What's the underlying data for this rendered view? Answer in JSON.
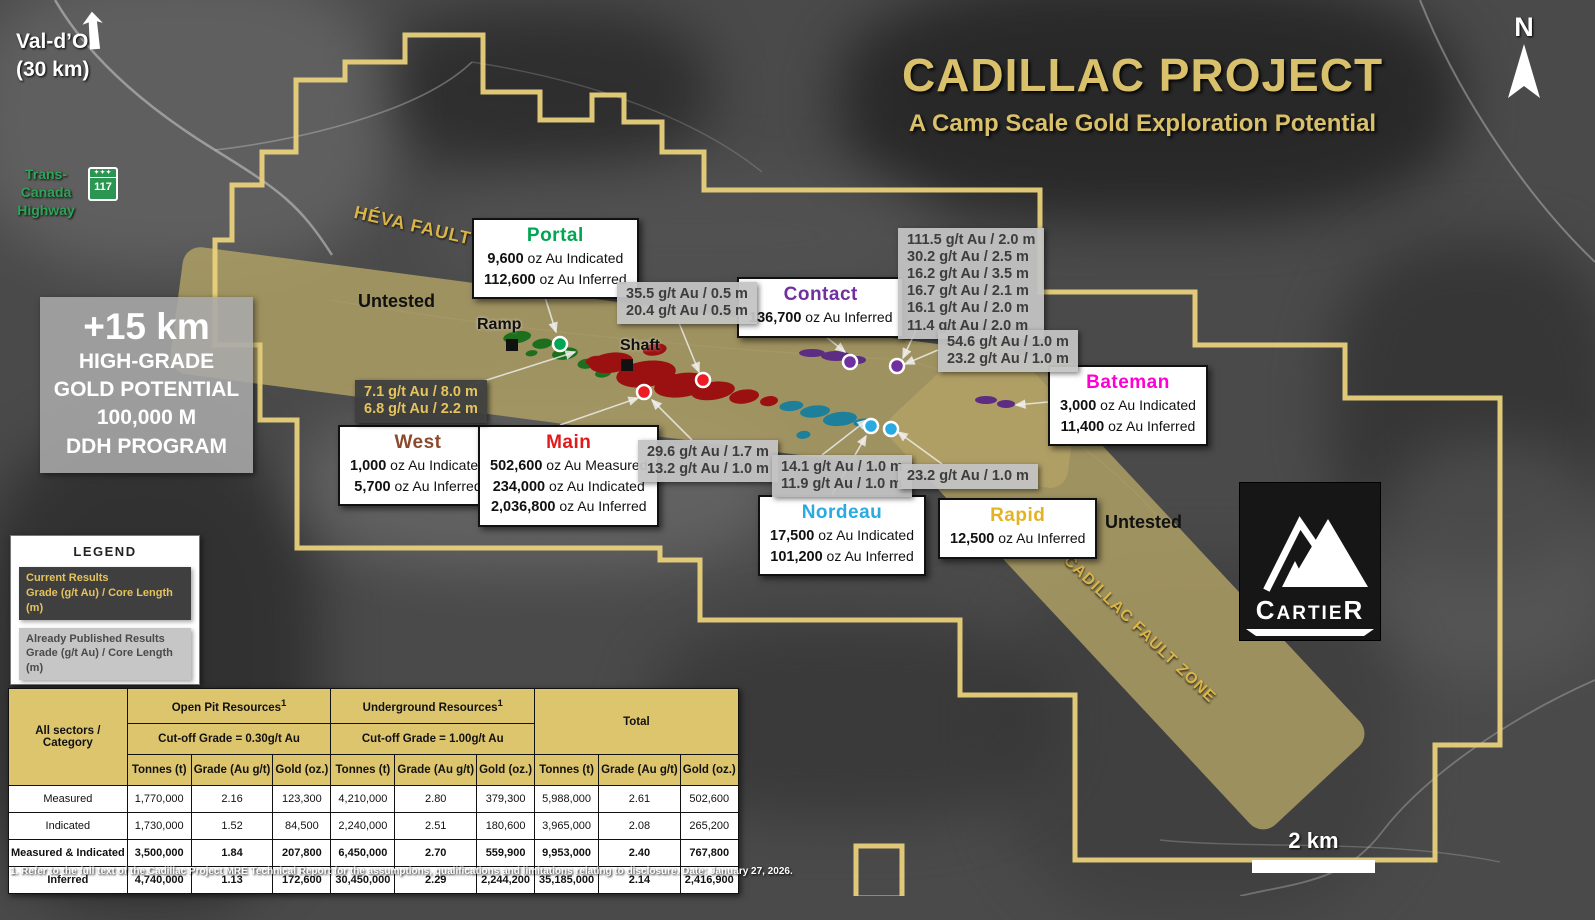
{
  "header": {
    "title": "CADILLAC PROJECT",
    "subtitle": "A Camp Scale Gold Exploration Potential"
  },
  "nav": {
    "val_dor": "Val-d’Or",
    "val_dor_dist": "(30 km)",
    "tch_line1": "Trans-Canada",
    "tch_line2": "Highway",
    "shield_num": "117",
    "north": "N",
    "scale": "2 km"
  },
  "map_labels": {
    "heva_fault": "HÉVA FAULT ZONE",
    "cadillac_fault": "CADILLAC FAULT ZONE",
    "untested_west": "Untested",
    "untested_east": "Untested",
    "ramp": "Ramp",
    "shaft": "Shaft"
  },
  "promo": {
    "lines": [
      "+15 km",
      "HIGH-GRADE",
      "GOLD POTENTIAL",
      "100,000 M",
      "DDH PROGRAM"
    ]
  },
  "zones": {
    "portal": {
      "name": "Portal",
      "color": "#00a651",
      "stats": [
        {
          "value": "9,600",
          "label": " oz Au Indicated"
        },
        {
          "value": "112,600",
          "label": " oz Au Inferred"
        }
      ]
    },
    "contact": {
      "name": "Contact",
      "color": "#7030a0",
      "stats": [
        {
          "value": "136,700",
          "label": " oz Au Inferred"
        }
      ]
    },
    "bateman": {
      "name": "Bateman",
      "color": "#ff00d4",
      "stats": [
        {
          "value": "3,000",
          "label": " oz Au Indicated"
        },
        {
          "value": "11,400",
          "label": " oz Au Inferred"
        }
      ]
    },
    "west": {
      "name": "West",
      "color": "#8b4a2b",
      "stats": [
        {
          "value": "1,000",
          "label": " oz Au Indicated"
        },
        {
          "value": "5,700",
          "label": " oz Au Inferred"
        }
      ]
    },
    "main": {
      "name": "Main",
      "color": "#e01b1b",
      "stats": [
        {
          "value": "502,600",
          "label": " oz Au Measured"
        },
        {
          "value": "234,000",
          "label": " oz Au Indicated"
        },
        {
          "value": "2,036,800",
          "label": " oz Au Inferred"
        }
      ]
    },
    "nordeau": {
      "name": "Nordeau",
      "color": "#29abe2",
      "stats": [
        {
          "value": "17,500",
          "label": " oz Au Indicated"
        },
        {
          "value": "101,200",
          "label": " oz Au Inferred"
        }
      ]
    },
    "rapid": {
      "name": "Rapid",
      "color": "#e4b323",
      "stats": [
        {
          "value": "12,500",
          "label": " oz Au Inferred"
        }
      ]
    }
  },
  "published_results": {
    "box1": [
      "35.5 g/t Au / 0.5 m",
      "20.4 g/t Au / 0.5 m"
    ],
    "box2": [
      "111.5 g/t Au / 2.0 m",
      "30.2 g/t Au / 2.5 m",
      "16.2 g/t Au / 3.5 m",
      "16.7 g/t Au / 2.1 m",
      "16.1 g/t Au / 2.0 m",
      "11.4 g/t Au / 2.0 m"
    ],
    "box3": [
      "54.6 g/t Au / 1.0 m",
      "23.2 g/t Au / 1.0 m"
    ],
    "box4": [
      "29.6 g/t Au / 1.7 m",
      "13.2 g/t Au / 1.0 m"
    ],
    "box5": [
      "14.1 g/t Au / 1.0 m",
      "11.9 g/t Au / 1.0 m"
    ],
    "box6": [
      "23.2 g/t Au / 1.0 m"
    ]
  },
  "current_results": [
    "7.1 g/t Au / 8.0 m",
    "6.8 g/t Au / 2.2 m"
  ],
  "legend": {
    "title": "LEGEND",
    "current_title": "Current Results",
    "current_sub": "Grade (g/t Au) / Core Length (m)",
    "published_title": "Already Published Results",
    "published_sub": "Grade (g/t Au) / Core Length (m)",
    "date": "March 2026"
  },
  "table": {
    "header": {
      "category1": "All sectors /",
      "category2": "Category",
      "open_pit": "Open Pit Resources",
      "open_pit_sup": "1",
      "open_pit_cutoff": "Cut-off Grade = 0.30g/t Au",
      "underground": "Underground Resources",
      "underground_sup": "1",
      "underground_cutoff": "Cut-off Grade = 1.00g/t Au",
      "total": "Total"
    },
    "subcols": [
      "Tonnes (t)",
      "Grade (Au g/t)",
      "Gold (oz.)"
    ],
    "rows": [
      {
        "category": "Measured",
        "cells": [
          "1,770,000",
          "2.16",
          "123,300",
          "4,210,000",
          "2.80",
          "379,300",
          "5,988,000",
          "2.61",
          "502,600"
        ]
      },
      {
        "category": "Indicated",
        "cells": [
          "1,730,000",
          "1.52",
          "84,500",
          "2,240,000",
          "2.51",
          "180,600",
          "3,965,000",
          "2.08",
          "265,200"
        ]
      },
      {
        "category": "Measured & Indicated",
        "cells": [
          "3,500,000",
          "1.84",
          "207,800",
          "6,450,000",
          "2.70",
          "559,900",
          "9,953,000",
          "2.40",
          "767,800"
        ]
      },
      {
        "category": "Inferred",
        "cells": [
          "4,740,000",
          "1.13",
          "172,600",
          "30,450,000",
          "2.29",
          "2,244,200",
          "35,185,000",
          "2.14",
          "2,416,900"
        ]
      }
    ]
  },
  "footnote": "1. Refer to the full text of the Cadillac Project MRE Technical Report for the assumptions, qualifications and limitations relating to disclosure. Date: January 27, 2026.",
  "logo": {
    "brand": "CARTIER"
  }
}
